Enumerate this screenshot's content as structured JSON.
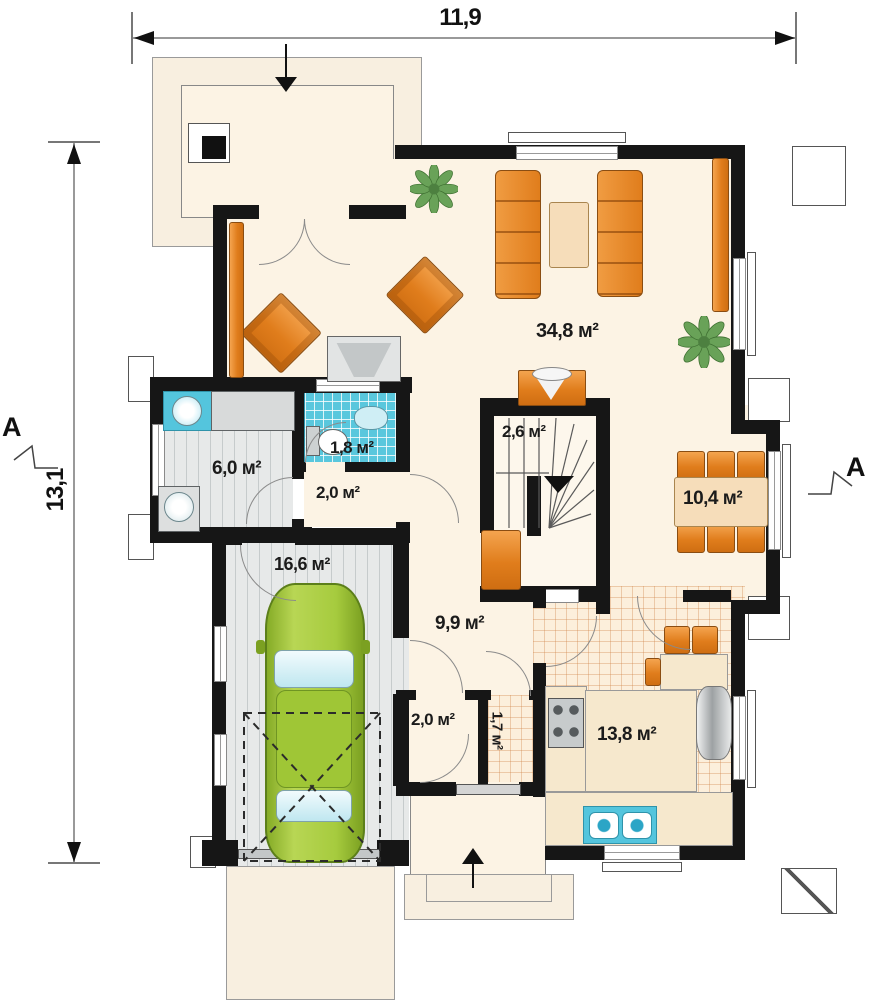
{
  "dimensions": {
    "width_label": "11,9",
    "height_label": "13,1"
  },
  "section_markers": {
    "left": "A",
    "right": "A"
  },
  "rooms": {
    "living_room": {
      "area_label": "34,8 м²"
    },
    "staircase": {
      "area_label": "2,6 м²"
    },
    "utility_room": {
      "area_label": "6,0 м²"
    },
    "wc": {
      "area_label": "1,8 м²"
    },
    "hallway_upper": {
      "area_label": "2,0 м²"
    },
    "dining_area": {
      "area_label": "10,4 м²"
    },
    "garage": {
      "area_label": "16,6 м²"
    },
    "entrance_hall": {
      "area_label": "9,9 м²"
    },
    "closet": {
      "area_label": "2,0 м²"
    },
    "pantry": {
      "area_label": "1,7 м²"
    },
    "kitchen": {
      "area_label": "13,8 м²"
    }
  },
  "palette": {
    "wall": "#161616",
    "floor_cream": "#fcf3e4",
    "furniture_orange": "#e8882b",
    "car_green": "#a3c93c",
    "fixture_blue": "#54c5dd",
    "floor_gray": "#e7e9e9"
  }
}
